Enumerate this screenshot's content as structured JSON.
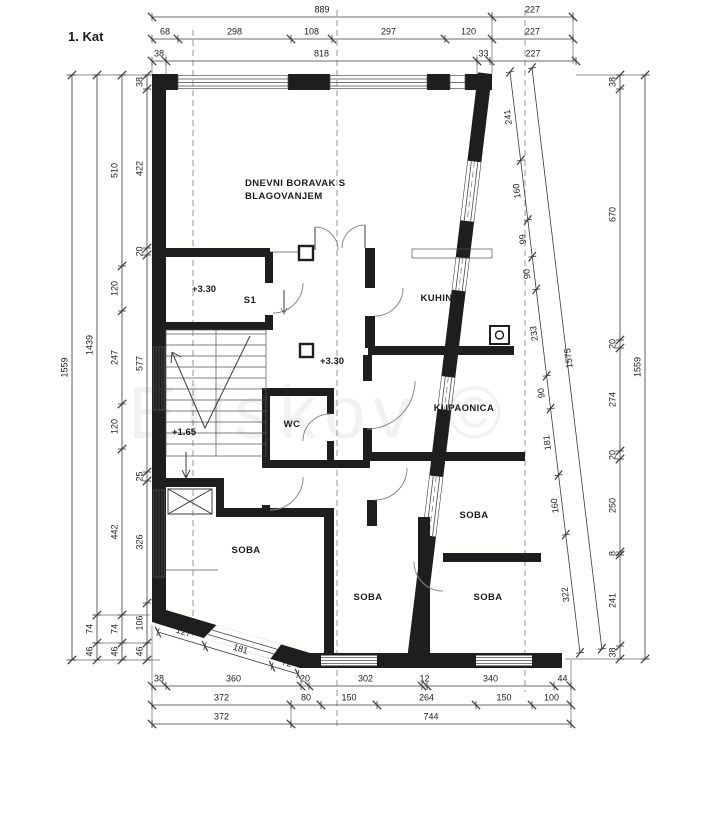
{
  "title": "1. Kat",
  "watermark": "Eliskov ©",
  "rooms": {
    "living_1": "DNEVNI BORAVAK S",
    "living_2": "BLAGOVANJEM",
    "kitchen": "KUHINJA",
    "bathroom": "KUPAONICA",
    "wc": "WC",
    "s1": "S1",
    "soba": "SOBA",
    "level_330": "+3.30",
    "level_165": "+1.65"
  },
  "symbols": {
    "boiler": "boiler-circle-symbol",
    "chimney": "chimney-flue-square",
    "shaft": "crossed-shaft",
    "stairs": "stair-flight-with-up-arrow"
  },
  "dimensions": {
    "units": "cm",
    "chains": [
      {
        "name": "top-total",
        "p0": [
          152,
          17
        ],
        "p1": [
          573,
          17
        ],
        "side": 1,
        "cuts": [
          0,
          340,
          421
        ],
        "values": [
          "889",
          "227"
        ]
      },
      {
        "name": "top-middle",
        "p0": [
          152,
          39
        ],
        "p1": [
          573,
          39
        ],
        "side": 1,
        "cuts": [
          0,
          26,
          139,
          180,
          293,
          340,
          421
        ],
        "values": [
          "68",
          "298",
          "108",
          "297",
          "120",
          "227"
        ]
      },
      {
        "name": "top-inner",
        "p0": [
          152,
          61
        ],
        "p1": [
          576,
          61
        ],
        "side": 1,
        "cuts": [
          0,
          14,
          325,
          338,
          424
        ],
        "values": [
          "38",
          "818",
          "33",
          "227"
        ]
      },
      {
        "name": "left-total",
        "p0": [
          72,
          75
        ],
        "p1": [
          72,
          660
        ],
        "side": -1,
        "cuts": [
          0,
          585
        ],
        "values": [
          "1559"
        ]
      },
      {
        "name": "left-2",
        "p0": [
          97,
          75
        ],
        "p1": [
          97,
          660
        ],
        "side": -1,
        "cuts": [
          0,
          540,
          568,
          585
        ],
        "values": [
          "1439",
          "74",
          "46"
        ]
      },
      {
        "name": "left-3",
        "p0": [
          122,
          75
        ],
        "p1": [
          122,
          660
        ],
        "side": -1,
        "cuts": [
          0,
          191,
          236,
          329,
          374,
          540,
          568,
          585
        ],
        "values": [
          "510",
          "120",
          "247",
          "120",
          "442",
          "74",
          "46"
        ]
      },
      {
        "name": "left-inner",
        "p0": [
          147,
          75
        ],
        "p1": [
          147,
          660
        ],
        "side": -1,
        "cuts": [
          0,
          14,
          173,
          180,
          397,
          406,
          528,
          568,
          585
        ],
        "values": [
          "38",
          "422",
          "20",
          "577",
          "25",
          "326",
          "106",
          "46"
        ]
      },
      {
        "name": "right-inner",
        "p0": [
          620,
          75
        ],
        "p1": [
          620,
          659
        ],
        "side": -1,
        "cuts": [
          0,
          14,
          265,
          273,
          376,
          384,
          477,
          480,
          571,
          584
        ],
        "values": [
          "38",
          "670",
          "20",
          "274",
          "20",
          "250",
          "8",
          "241",
          "38"
        ]
      },
      {
        "name": "right-total",
        "p0": [
          645,
          75
        ],
        "p1": [
          645,
          659
        ],
        "side": -1,
        "cuts": [
          0,
          584
        ],
        "values": [
          "1559"
        ]
      },
      {
        "name": "slant-inner",
        "p0": [
          510,
          72
        ],
        "p1": [
          580,
          653
        ],
        "side": -1,
        "cuts": [
          0,
          89,
          149,
          186,
          219,
          306,
          339,
          406,
          466,
          585
        ],
        "values": [
          "241",
          "160",
          "99",
          "90",
          "233",
          "90",
          "181",
          "160",
          "322"
        ]
      },
      {
        "name": "slant-total",
        "p0": [
          532,
          68
        ],
        "p1": [
          602,
          650
        ],
        "side": 1,
        "cuts": [
          0,
          585
        ],
        "values": [
          "1575"
        ]
      },
      {
        "name": "bottom-inner",
        "p0": [
          152,
          686
        ],
        "p1": [
          571,
          686
        ],
        "side": 1,
        "cuts": [
          0,
          14,
          149,
          157,
          270,
          275,
          402,
          419
        ],
        "values": [
          "38",
          "360",
          "20",
          "302",
          "12",
          "340",
          "44"
        ]
      },
      {
        "name": "bottom-middle",
        "p0": [
          152,
          705
        ],
        "p1": [
          571,
          705
        ],
        "side": 1,
        "cuts": [
          0,
          139,
          169,
          225,
          324,
          380,
          419
        ],
        "values": [
          "372",
          "80",
          "150",
          "264",
          "150",
          "100"
        ]
      },
      {
        "name": "bottom-total",
        "p0": [
          152,
          724
        ],
        "p1": [
          571,
          724
        ],
        "side": 1,
        "cuts": [
          0,
          139,
          419
        ],
        "values": [
          "372",
          "744"
        ]
      },
      {
        "name": "slanted-wall-bottom-left",
        "p0": [
          158,
          632
        ],
        "p1": [
          298,
          674
        ],
        "side": 1,
        "cuts": [
          0,
          49,
          119,
          146
        ],
        "values": [
          "127",
          "181",
          "72"
        ]
      }
    ]
  }
}
